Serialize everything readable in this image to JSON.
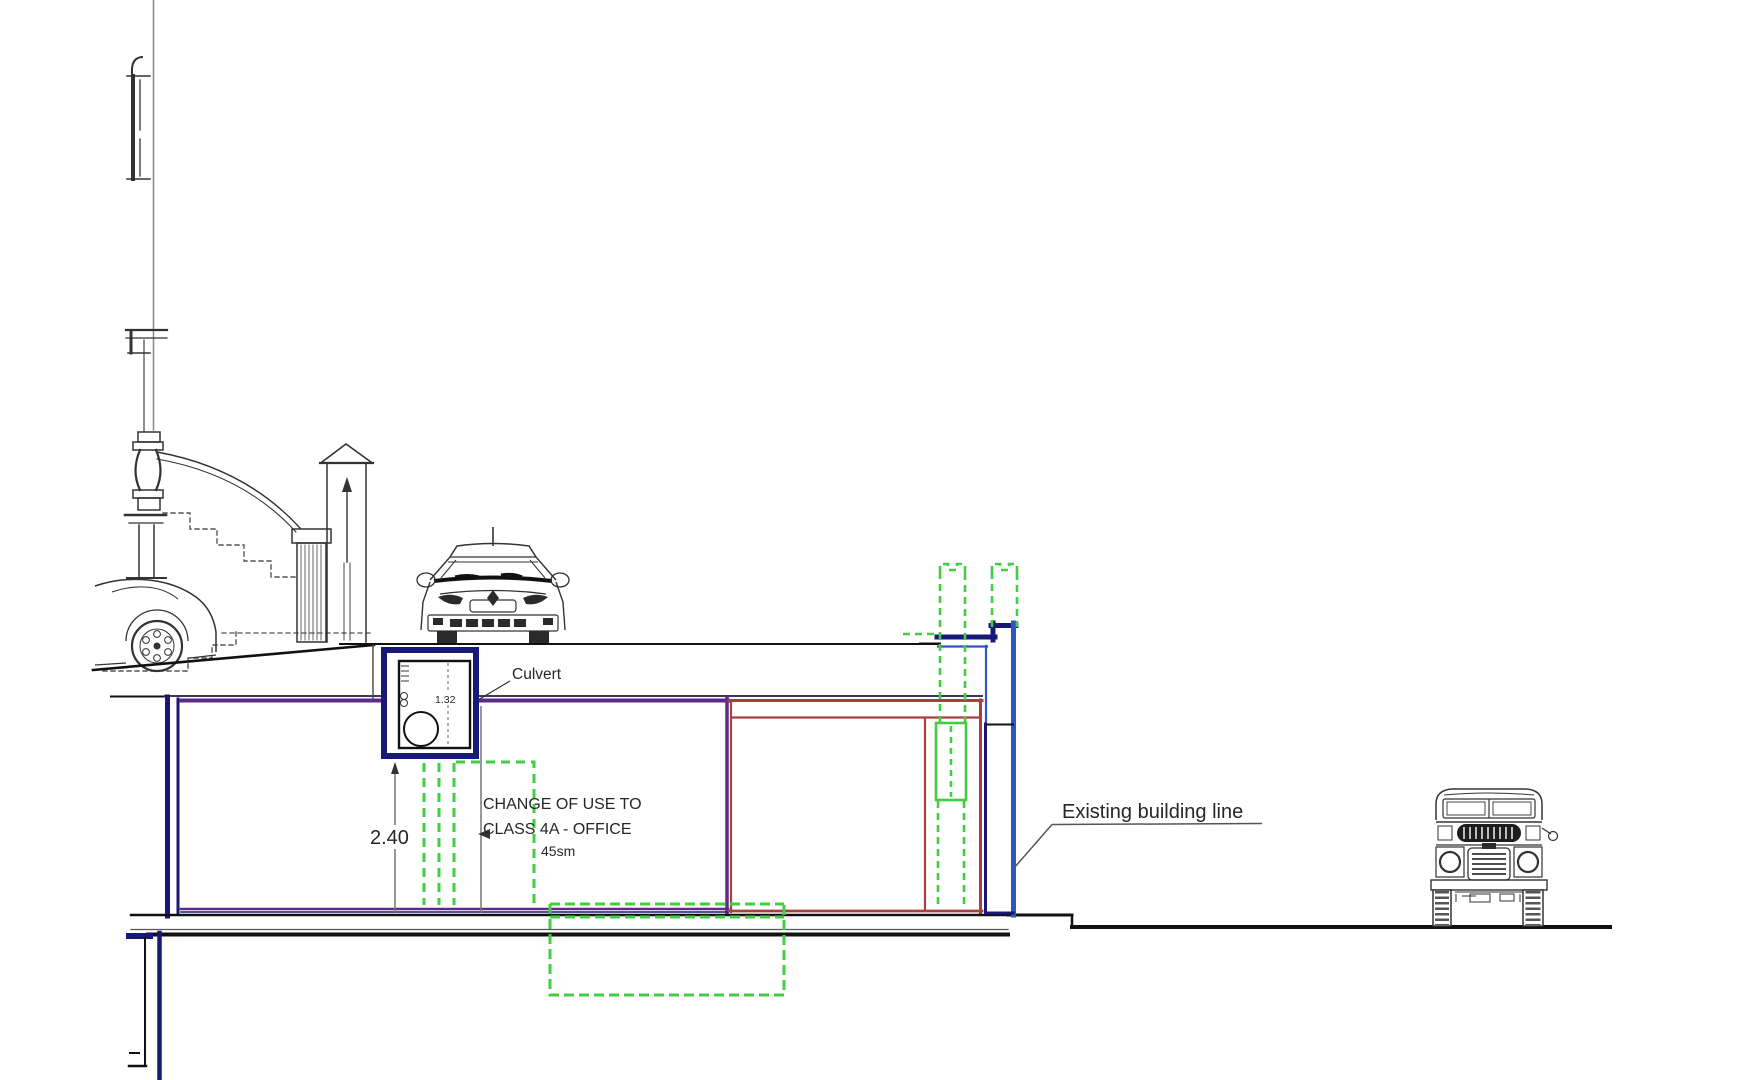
{
  "drawing": {
    "labels": {
      "culvert": "Culvert",
      "change_of_use_line1": "CHANGE OF USE TO",
      "change_of_use_line2": "CLASS 4A - OFFICE",
      "change_of_use_line3": "45sm",
      "existing_building_line": "Existing building line"
    },
    "dimensions": {
      "room_height_m": "2.40",
      "culvert_width_m": "1.32"
    },
    "colors": {
      "navy": "#181878",
      "royal_blue": "#2e55c4",
      "purple": "#5e2a87",
      "brick_red": "#a84040",
      "proposal_green": "#42cd42",
      "line_black": "#1a1a1a"
    }
  }
}
